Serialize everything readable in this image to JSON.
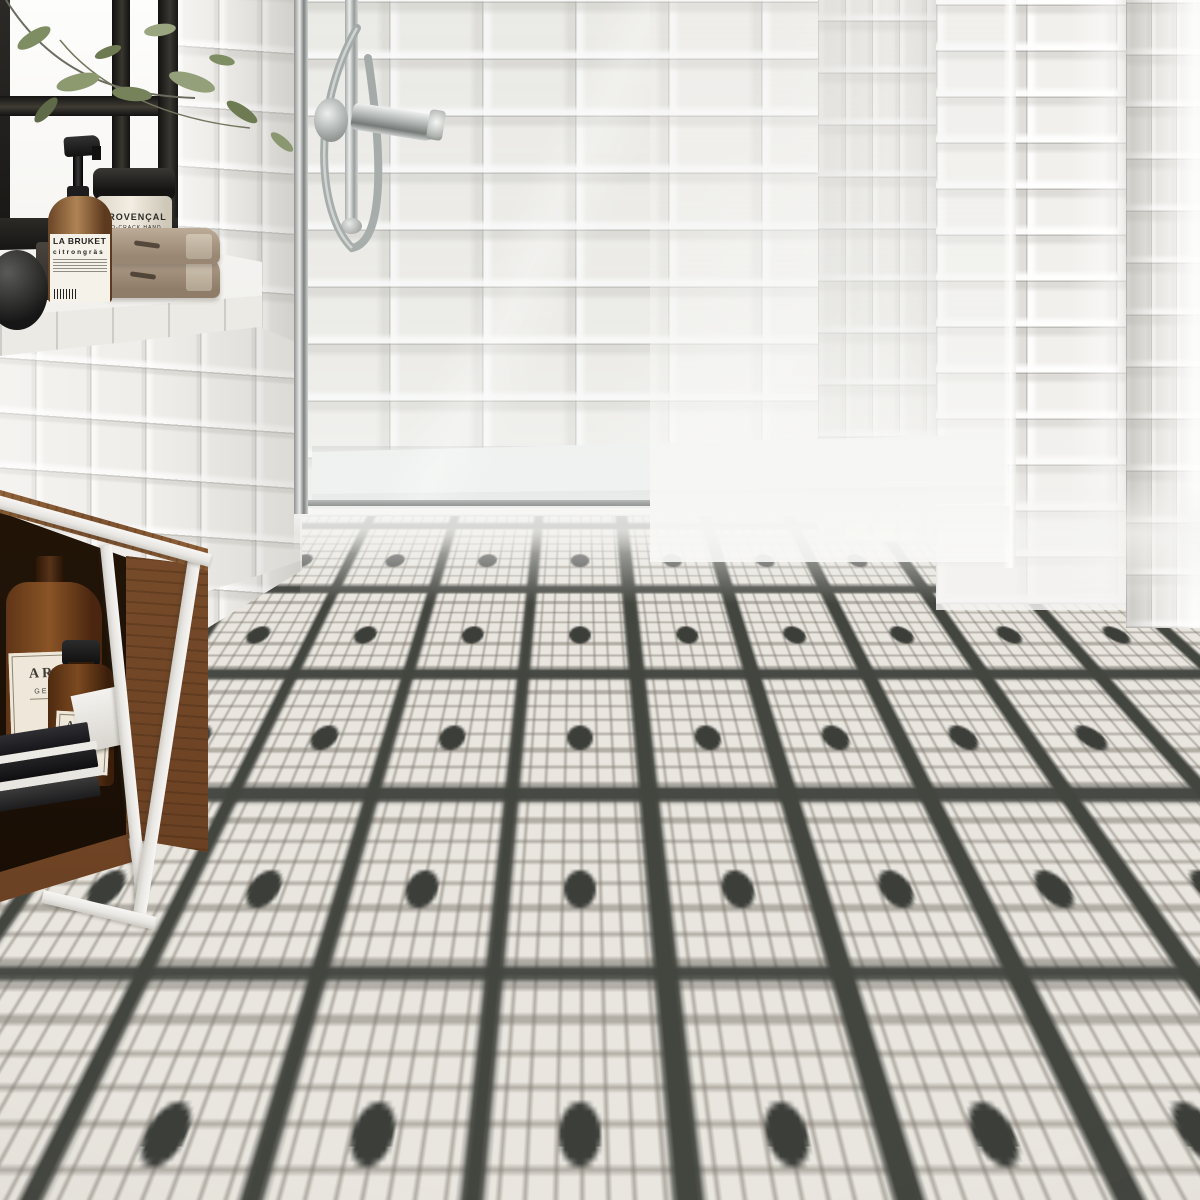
{
  "scene": {
    "description": "Bathroom interior render: white bevelled metro-tile walls, black and white mosaic floor, walk-in glass shower with chrome hand shower, window shelf with toiletries and towels, walnut bench with white steel frame",
    "palette": {
      "wall_tile": "#efede9",
      "grout": "#d9d7d2",
      "floor_tile": "#e9e6df",
      "floor_accent": "#3c3e3a",
      "wood": "#8a5c36",
      "frame_white": "#f3f2f0",
      "towel": "#a5937f",
      "amber_glass": "#6e4120",
      "chrome": "#b9bdbc",
      "leaf_green": "#7e905e",
      "window_frame": "#1f1e1c"
    }
  },
  "shelf": {
    "pump_bottle": {
      "brand": "LA BRUKET",
      "variant": "citrongräs"
    },
    "jar": {
      "line1": "PROVENÇAL",
      "line2": "NO-CRACK HAND"
    },
    "towels_count": 2
  },
  "bench": {
    "gel_bottle": {
      "title": "ARG",
      "subtitle": "GEL D"
    },
    "oil_bottle": {
      "title": "ARG",
      "subtitle": "HUILE DE"
    },
    "books_count": 4
  }
}
